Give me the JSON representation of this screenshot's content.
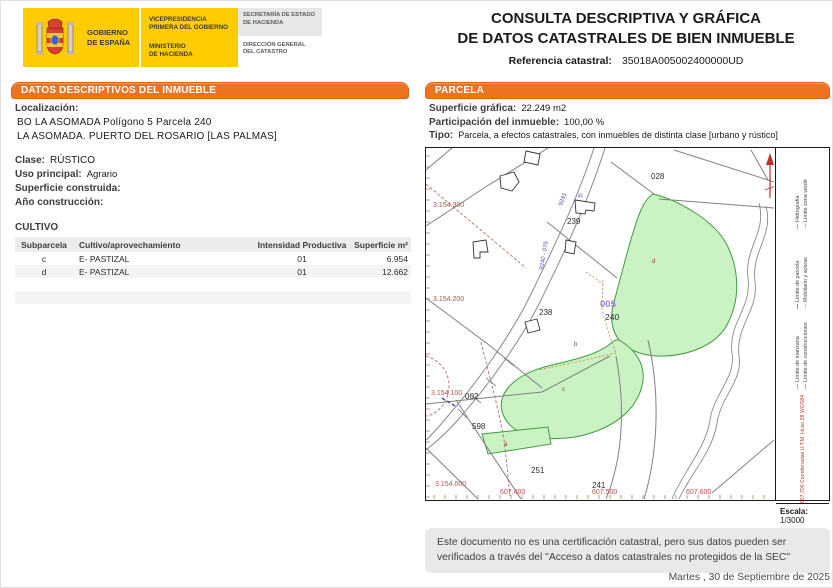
{
  "header": {
    "logo": {
      "gobierno": "GOBIERNO\nDE ESPAÑA",
      "vicepresidencia": "VICEPRESIDENCIA\nPRIMERA DEL GOBIERNO",
      "ministerio": "MINISTERIO\nDE HACIENDA",
      "secretaria": "SECRETARÍA DE ESTADO\nDE HACIENDA",
      "direccion": "DIRECCIÓN GENERAL\nDEL CATASTRO"
    },
    "title_line1": "CONSULTA DESCRIPTIVA Y GRÁFICA",
    "title_line2": "DE DATOS CATASTRALES DE BIEN INMUEBLE",
    "ref_label": "Referencia catastral:",
    "ref_value": "35018A005002400000UD"
  },
  "left_panel": {
    "section_title": "DATOS DESCRIPTIVOS DEL INMUEBLE",
    "localizacion_label": "Localización:",
    "localizacion_line1": "BO LA ASOMADA  Polígono 5 Parcela 240",
    "localizacion_line2": "LA ASOMADA. PUERTO DEL ROSARIO [LAS PALMAS]",
    "clase_label": "Clase:",
    "clase_value": "RÚSTICO",
    "uso_label": "Uso principal:",
    "uso_value": "Agrario",
    "superficie_label": "Superficie construida:",
    "superficie_value": "",
    "anio_label": "Año construcción:",
    "anio_value": "",
    "cultivo": {
      "title": "CULTIVO",
      "headers": [
        "Subparcela",
        "Cultivo/aprovechamiento",
        "Intensidad Productiva",
        "Superficie m²"
      ],
      "rows": [
        [
          "c",
          "E- PASTIZAL",
          "01",
          "6.954"
        ],
        [
          "d",
          "E- PASTIZAL",
          "01",
          "12.662"
        ]
      ]
    }
  },
  "right_panel": {
    "section_title": "PARCELA",
    "superficie_label": "Superficie gráfica:",
    "superficie_value": "22.249 m2",
    "participacion_label": "Participación del inmueble:",
    "participacion_value": "100,00 %",
    "tipo_label": "Tipo:",
    "tipo_value": "Parcela, a efectos catastrales, con inmuebles de distinta clase [urbano y rústico]",
    "map": {
      "labels": {
        "p028": "028",
        "p239": "239",
        "p238": "238",
        "p002": "002",
        "p598": "598",
        "p251": "251",
        "p241": "241"
      },
      "subject": {
        "polygon_code": "005",
        "parcel_code": "240"
      },
      "subparcels": {
        "a": "a",
        "b": "b",
        "c": "c",
        "d": "d"
      },
      "coords": {
        "y1": "3.154.300",
        "y2": "3.154.200",
        "y3": "3.154.100",
        "y4": "3.154.000",
        "x1": "607.400",
        "x2": "607.500",
        "x3": "607.600"
      },
      "road_label_1": "9240 - 079",
      "road_label_2": "9241",
      "building_label": "42",
      "colors": {
        "parcel_fill": "#CBF2C3",
        "parcel_stroke": "#3E9C3E",
        "coord_text": "#B5524C",
        "polygon_code": "#9B7FC7",
        "boundary_gray": "#808080",
        "dashed_brown": "#B0604F"
      }
    },
    "legend": {
      "entries": [
        {
          "label": "Hidrografía",
          "color": "#4A6FD0"
        },
        {
          "label": "Límite zona verde",
          "color": "#6ABF69"
        },
        {
          "label": "Límite de parcela",
          "color": "#333333"
        },
        {
          "label": "Mobiliario y aceras",
          "color": "#AAAAAA"
        },
        {
          "label": "Límite de manzana",
          "color": "#8A5FB8"
        },
        {
          "label": "Límite de construcciones",
          "color": "#B0604F"
        }
      ],
      "utm_note": "607.700 Coordenadas U.T.M. Huso 28 WGS84",
      "escala_label": "Escala:",
      "escala_value": "1/3000"
    }
  },
  "footer": {
    "note": "Este documento no es una certificación catastral, pero sus datos pueden ser verificados a través del \"Acceso a datos catastrales no protegidos de la SEC\"",
    "date": "Martes , 30 de Septiembre de 2025"
  },
  "theme_colors": {
    "accent_orange": "#ED7320",
    "header_yellow": "#FFCC00"
  }
}
